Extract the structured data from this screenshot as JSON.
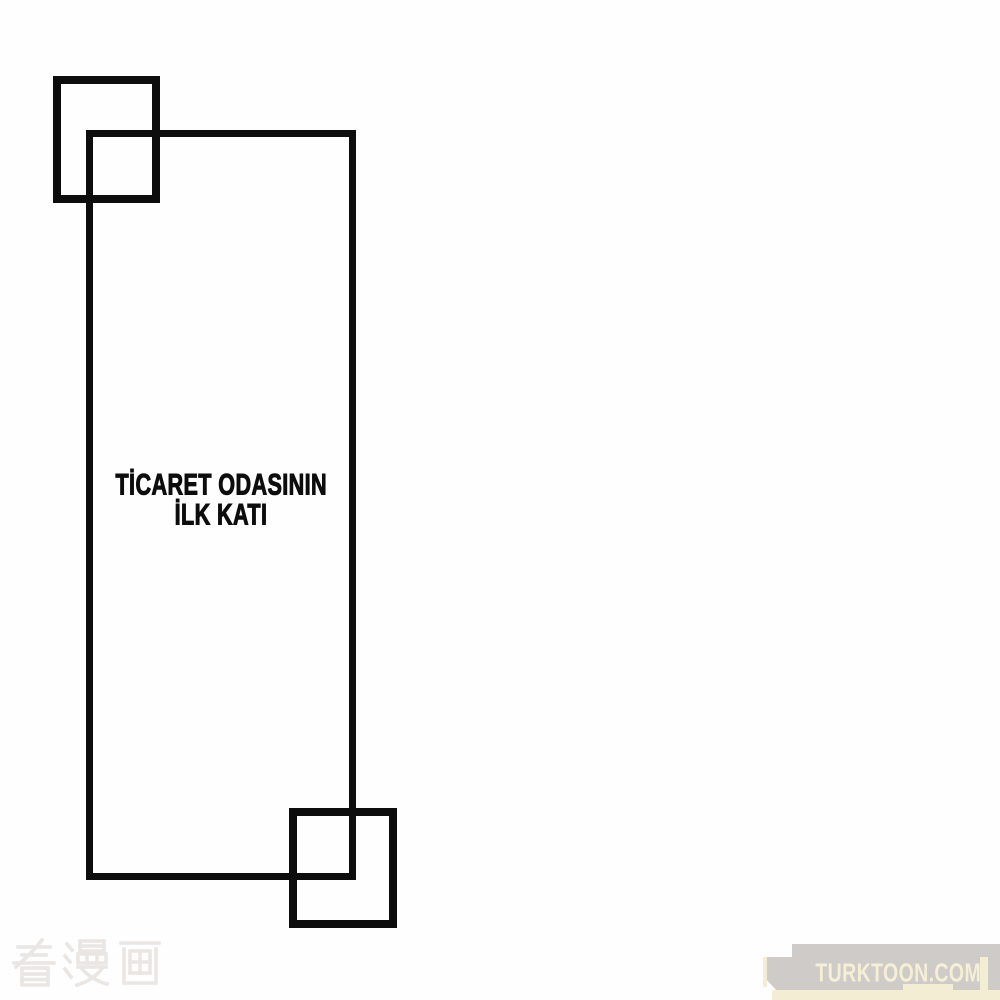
{
  "colors": {
    "paper": "#fefefe",
    "ink": "#0d0d0d",
    "faint_watermark": "#e9e6e3",
    "banner_gray": "#cecbc8",
    "banner_accent": "#f3edd3",
    "banner_text": "#f5efd6"
  },
  "panel": {
    "caption": {
      "line1": "TİCARET ODASININ",
      "line2": "İLK KATI"
    }
  },
  "watermarks": {
    "site_cn": {
      "text": "看漫画"
    },
    "site_banner": {
      "text": "TURKTOON.COM"
    }
  }
}
